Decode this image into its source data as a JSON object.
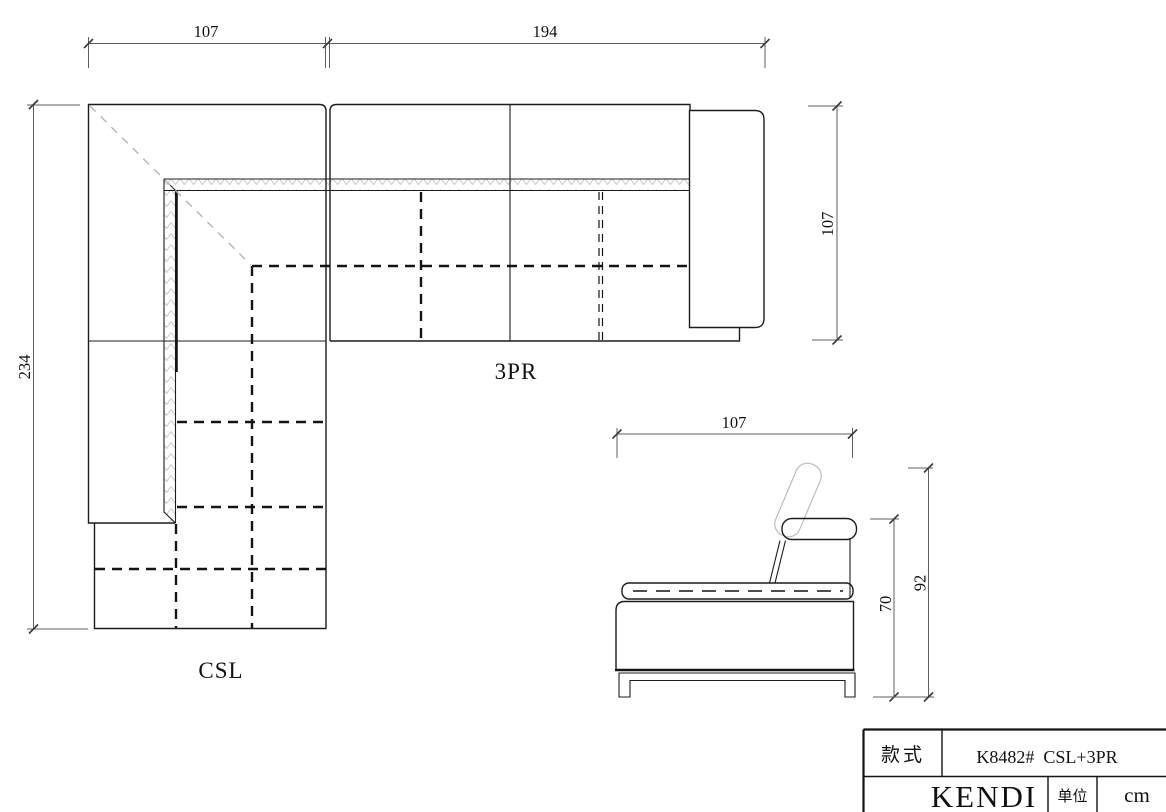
{
  "drawing": {
    "plan": {
      "label_csl": "CSL",
      "label_3pr": "3PR",
      "dim_csl_width": "107",
      "dim_3pr_width": "194",
      "dim_total_depth": "234",
      "dim_3pr_depth": "107"
    },
    "side": {
      "dim_depth": "107",
      "dim_back_height": "70",
      "dim_total_height": "92"
    },
    "title_block": {
      "style_label": "款式",
      "model": "K8482#  CSL+3PR",
      "brand": "KENDI",
      "unit_label": "单位",
      "unit_value": "cm"
    },
    "colors": {
      "line": "#1c1c1c",
      "dimension_line": "#5f5f5f",
      "hatch": "#c9c9c9",
      "ghost": "#bdbdbd",
      "background": "#ffffff"
    }
  }
}
